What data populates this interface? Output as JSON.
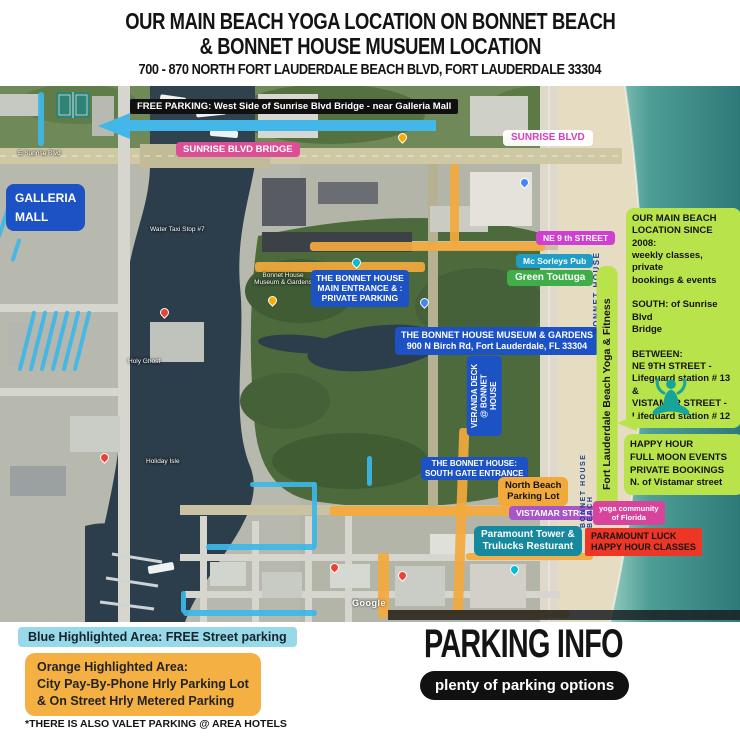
{
  "header": {
    "title_line1": "OUR MAIN BEACH YOGA LOCATION ON BONNET BEACH",
    "title_line2": "&  BONNET HOUSE MUSUEM LOCATION",
    "subtitle": "700 - 870  NORTH FORT LAUDERDALE BEACH BLVD, FORT LAUDERDALE 33304"
  },
  "map": {
    "banner_free_parking": "FREE PARKING: West Side of Sunrise Blvd Bridge - near Galleria Mall",
    "labels": {
      "sunrise_blvd_bridge": "SUNRISE BLVD BRIDGE",
      "sunrise_blvd": "SUNRISE BLVD",
      "galleria_mall": "GALLERIA\nMALL",
      "ne_9th_street": "NE 9 th STREET",
      "mc_sorleys_pub": "Mc Sorleys Pub",
      "green_toutuga": "Green Toutuga",
      "bonnet_main_entrance": "THE BONNET HOUSE\nMAIN ENTRANCE & :\nPRIVATE PARKING",
      "bonnet_museum_address": "THE BONNET HOUSE MUSEUM & GARDENS\n900 N Birch Rd, Fort Lauderdale, FL 33304",
      "veranda_deck": "VERANDA DECK\n@ BONNET HOUSE",
      "south_gate": "THE BONNET HOUSE:\nSOUTH GATE ENTRANCE",
      "north_beach_lot": "North Beach\nParking Lot",
      "vistamar_street": "VISTAMAR STREET",
      "paramount_tower": "Paramount Tower &\nTrulucks  Resturant",
      "bonnet_house_beach": "BONNET HOUSE  BEACH",
      "yoga_strip": "Fort Lauderdale Beach Yoga & Fitness",
      "yoga_community": "yoga community\nof Florida",
      "paramount_luck": "PARAMOUNT LUCK\nHAPPY HOUR CLASSES"
    },
    "info_box_main": "OUR MAIN BEACH\nLOCATION SINCE 2008:\nweekly classes, private\nbookings & events\n\nSOUTH: of Sunrise Blvd\nBridge\n\nBETWEEN:\nNE 9TH STREET -\nLifeguard station # 13\n&\nVISTAMAR STREET -\nLifeguard station # 12",
    "info_box_happy_hour": "HAPPY HOUR\nFULL MOON EVENTS\nPRIVATE BOOKINGS\nN. of Vistamar street",
    "place_labels": {
      "water_taxi": "Water Taxi Stop #7",
      "holy_ghost": "Holy Ghost",
      "holiday_isle": "Holiday Isle",
      "bonnet_small": "Bonnet House\nMuseum & Gardens",
      "sunrise_road": "E Sunrise Blvd",
      "google_watermark": "Google"
    }
  },
  "legend": {
    "blue": "Blue Highlighted Area: FREE Street parking",
    "orange": "Orange Highlighted Area:\nCity Pay-By-Phone Hrly Parking Lot\n& On Street Hrly Metered Parking",
    "footnote": "*THERE IS ALSO VALET PARKING @ AREA HOTELS"
  },
  "parking_info": {
    "title": "PARKING INFO",
    "pill": "plenty of parking options"
  },
  "colors": {
    "blue_highlight": "#3db7e8",
    "orange_highlight": "#f3a93c",
    "lime_box": "#b9e34b",
    "label_blue": "#1d52c4",
    "bridge_pink": "#dd4f95",
    "magenta": "#cf3fd1",
    "pub_teal": "#1e9ec6",
    "paramount_teal": "#17899e",
    "green_label": "#3fae49",
    "red_label": "#ee3627",
    "purple_label": "#a855c8",
    "community_pink": "#d8439c",
    "legend_blue": "#97d9e8",
    "legend_orange": "#f5b043",
    "yoga_icon_teal": "#16a49b",
    "beach_text_navy": "#1d3f94"
  }
}
